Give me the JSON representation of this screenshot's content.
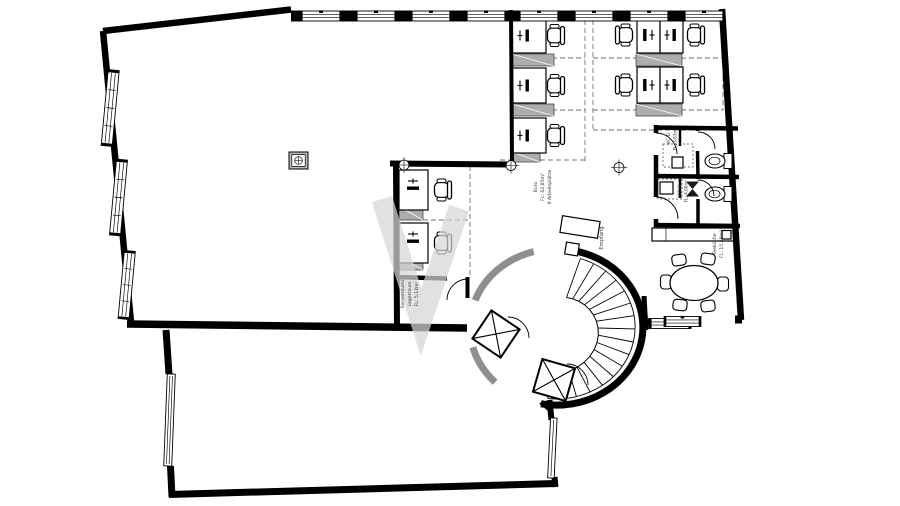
{
  "plan": {
    "colors": {
      "wall": "#000000",
      "faded_wall": "#8f8f8f",
      "cabinet_gray": "#adadad",
      "watermark": "#d6d6d6"
    },
    "rooms": {
      "buero": {
        "name": "Büro",
        "area": "FL: 62,85m²",
        "workplaces": "9 Arbeitsplätze"
      },
      "serverraum": {
        "name": "Serverraum/",
        "name2": "Lagerraum",
        "area": "FL: 5,12m²"
      },
      "empfang": {
        "name": "Empfang"
      },
      "wc_damen": {
        "name": "WC-D",
        "area": "FL: 3,63m²"
      },
      "wc_herren": {
        "name": "WC-H",
        "area": "FL: 4,60m²"
      },
      "teekueche": {
        "name": "Teeküche",
        "area": "FL: 15,48m²"
      }
    }
  }
}
